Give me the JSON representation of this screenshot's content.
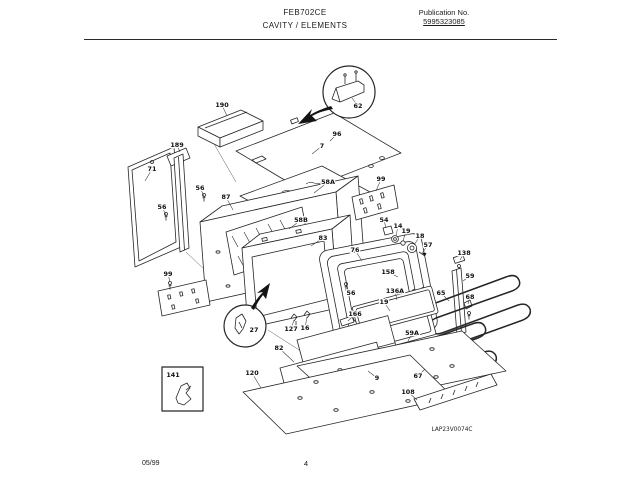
{
  "header": {
    "model": "FEB702CE",
    "section": "CAVITY / ELEMENTS",
    "publication_label": "Publication No.",
    "publication_number": "5995323085"
  },
  "footer": {
    "date_code": "05/99",
    "page_number": "4"
  },
  "diagram": {
    "drawing_code": "LAP23V0074C",
    "callouts": [
      {
        "t": "190",
        "x": 222,
        "y": 105,
        "lx": 227,
        "ly": 116
      },
      {
        "t": "189",
        "x": 177,
        "y": 145,
        "lx": 180,
        "ly": 152
      },
      {
        "t": "62",
        "x": 358,
        "y": 106,
        "lx": 352,
        "ly": 98
      },
      {
        "t": "96",
        "x": 337,
        "y": 134,
        "lx": 330,
        "ly": 141
      },
      {
        "t": "7",
        "x": 322,
        "y": 146,
        "lx": 312,
        "ly": 154
      },
      {
        "t": "71",
        "x": 152,
        "y": 169,
        "lx": 145,
        "ly": 181
      },
      {
        "t": "58A",
        "x": 328,
        "y": 182,
        "lx": 314,
        "ly": 193
      },
      {
        "t": "99",
        "x": 381,
        "y": 179,
        "lx": 376,
        "ly": 191
      },
      {
        "t": "56",
        "x": 200,
        "y": 188,
        "lx": 204,
        "ly": 196
      },
      {
        "t": "87",
        "x": 226,
        "y": 197,
        "lx": 233,
        "ly": 210
      },
      {
        "t": "56",
        "x": 162,
        "y": 207,
        "lx": 166,
        "ly": 215
      },
      {
        "t": "58B",
        "x": 301,
        "y": 220,
        "lx": 289,
        "ly": 229
      },
      {
        "t": "54",
        "x": 384,
        "y": 220,
        "lx": 386,
        "ly": 228
      },
      {
        "t": "14",
        "x": 398,
        "y": 226,
        "lx": 396,
        "ly": 236
      },
      {
        "t": "19",
        "x": 406,
        "y": 231,
        "lx": 403,
        "ly": 241
      },
      {
        "t": "18",
        "x": 420,
        "y": 236,
        "lx": 414,
        "ly": 245
      },
      {
        "t": "83",
        "x": 323,
        "y": 238,
        "lx": 311,
        "ly": 246
      },
      {
        "t": "57",
        "x": 428,
        "y": 245,
        "lx": 423,
        "ly": 252
      },
      {
        "t": "76",
        "x": 355,
        "y": 250,
        "lx": 362,
        "ly": 261
      },
      {
        "t": "138",
        "x": 464,
        "y": 253,
        "lx": 460,
        "ly": 260
      },
      {
        "t": "158",
        "x": 388,
        "y": 272,
        "lx": 398,
        "ly": 277
      },
      {
        "t": "99",
        "x": 168,
        "y": 274,
        "lx": 170,
        "ly": 282
      },
      {
        "t": "59",
        "x": 470,
        "y": 276,
        "lx": 463,
        "ly": 281
      },
      {
        "t": "136A",
        "x": 395,
        "y": 291,
        "lx": 397,
        "ly": 300
      },
      {
        "t": "65",
        "x": 441,
        "y": 293,
        "lx": 449,
        "ly": 301
      },
      {
        "t": "56",
        "x": 351,
        "y": 293,
        "lx": 347,
        "ly": 288
      },
      {
        "t": "68",
        "x": 470,
        "y": 297,
        "lx": 468,
        "ly": 304
      },
      {
        "t": "19",
        "x": 384,
        "y": 302,
        "lx": 390,
        "ly": 311
      },
      {
        "t": "166",
        "x": 355,
        "y": 314,
        "lx": 348,
        "ly": 321
      },
      {
        "t": "127",
        "x": 291,
        "y": 329,
        "lx": 294,
        "ly": 320
      },
      {
        "t": "16",
        "x": 305,
        "y": 328,
        "lx": 307,
        "ly": 317
      },
      {
        "t": "27",
        "x": 254,
        "y": 330
      },
      {
        "t": "59A",
        "x": 412,
        "y": 333,
        "lx": 408,
        "ly": 341
      },
      {
        "t": "82",
        "x": 279,
        "y": 348,
        "lx": 294,
        "ly": 362
      },
      {
        "t": "120",
        "x": 252,
        "y": 373,
        "lx": 261,
        "ly": 388
      },
      {
        "t": "141",
        "x": 173,
        "y": 375
      },
      {
        "t": "9",
        "x": 377,
        "y": 378,
        "lx": 368,
        "ly": 371
      },
      {
        "t": "67",
        "x": 418,
        "y": 376,
        "lx": 425,
        "ly": 369
      },
      {
        "t": "108",
        "x": 408,
        "y": 392,
        "lx": 417,
        "ly": 400
      }
    ]
  }
}
